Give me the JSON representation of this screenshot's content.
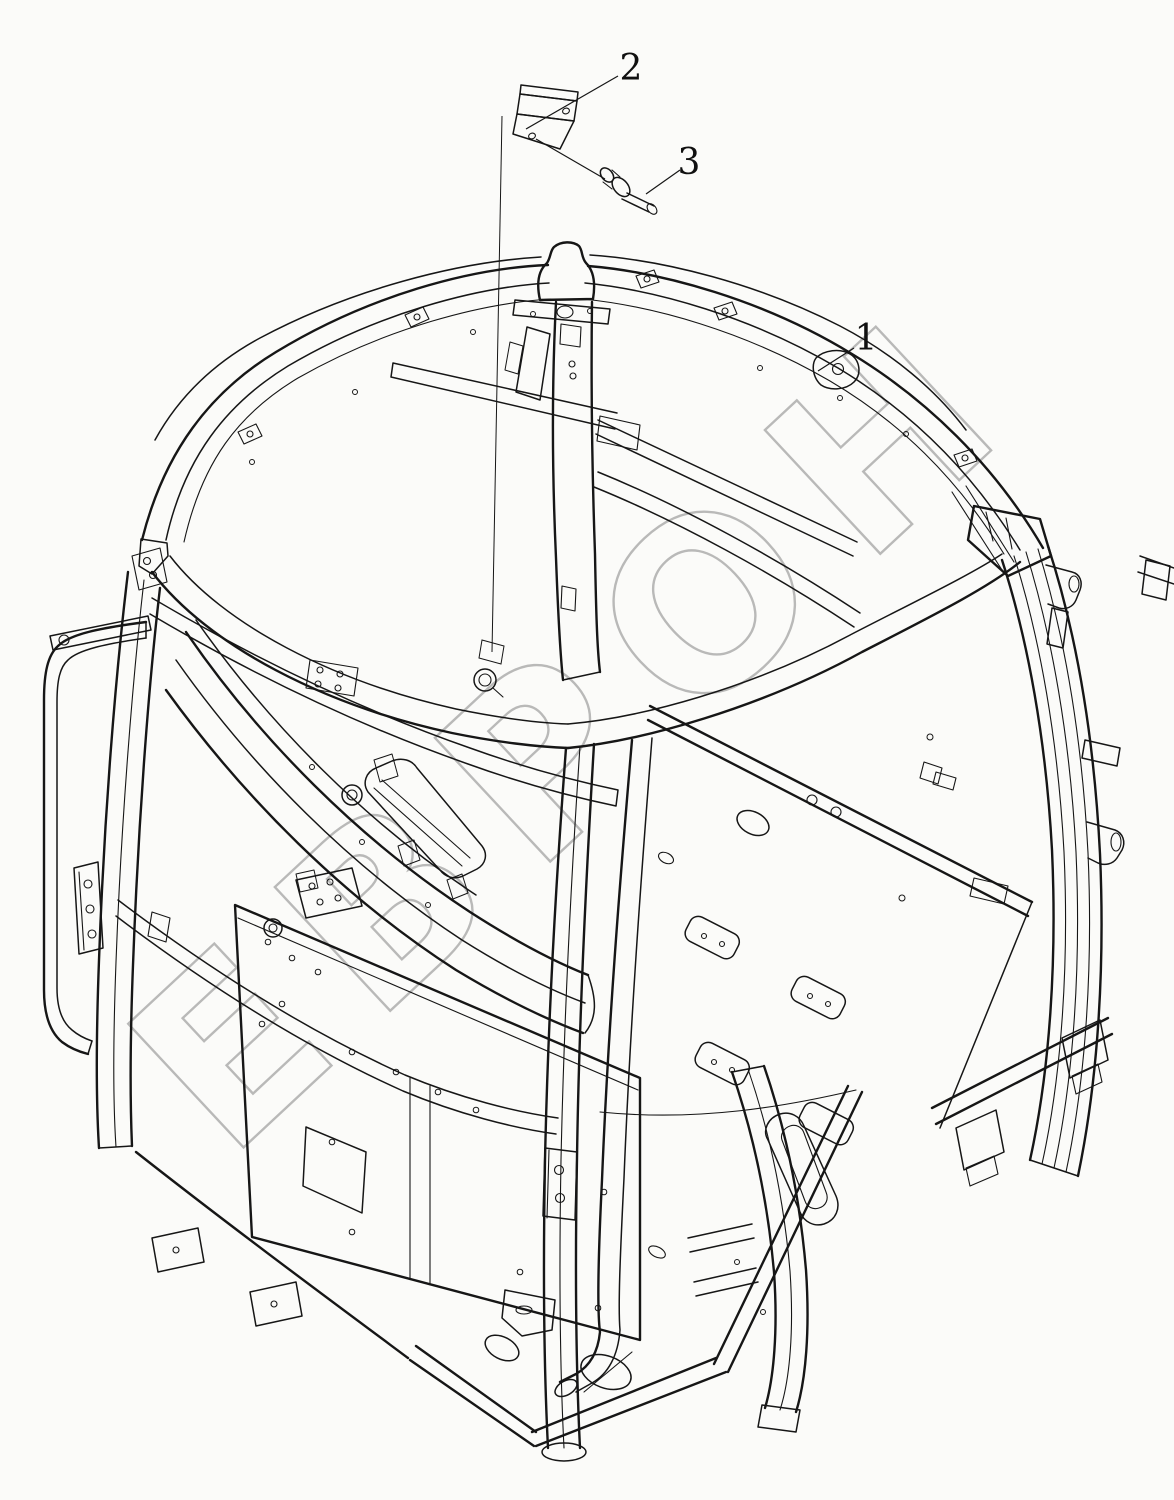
{
  "page": {
    "background_color": "#fbfbf9",
    "line_color": "#161616"
  },
  "watermark": {
    "text": "ЕВРОН",
    "color": "#a9a9a9"
  },
  "callouts": [
    {
      "number": "1"
    },
    {
      "number": "2"
    },
    {
      "number": "3"
    }
  ]
}
